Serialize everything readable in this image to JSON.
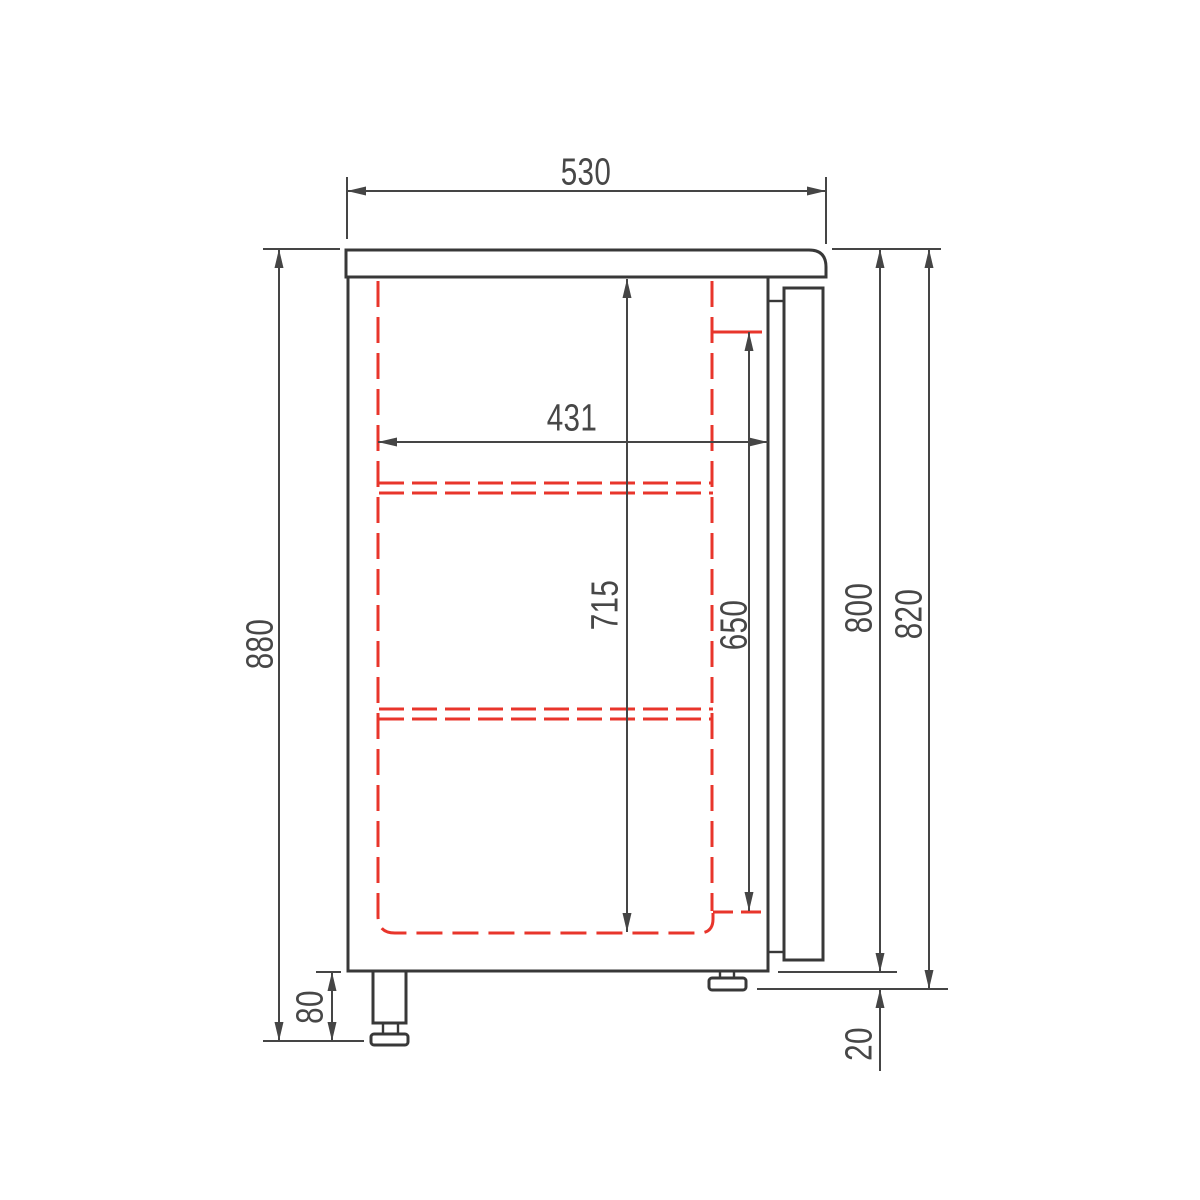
{
  "title": "Refrigerated cabinet side section technical drawing",
  "dims": {
    "countertop_depth": "530",
    "interior_depth": "431",
    "overall_height": "880",
    "interior_height": "715",
    "door_opening_height": "650",
    "body_height": "800",
    "body_plus_rear_foot_height": "820",
    "front_foot_height": "80",
    "rear_foot_height": "20"
  },
  "colors": {
    "background": "#ffffff",
    "outline": "#383838",
    "dimension": "#454545",
    "hidden_line_red": "#e8352b"
  }
}
